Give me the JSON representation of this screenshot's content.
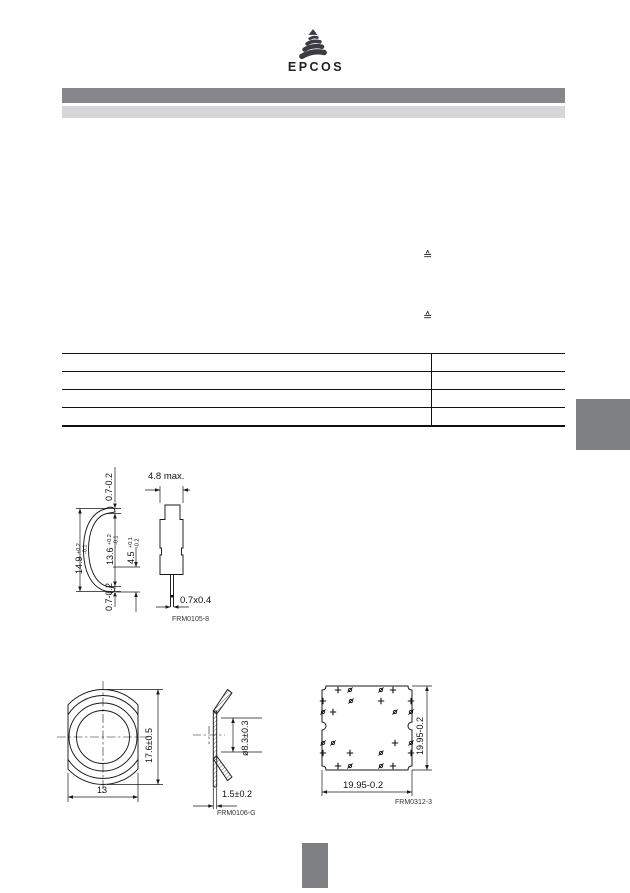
{
  "logo": {
    "text": "EPCOS",
    "icon_color": "#3a3b43",
    "text_color": "#1f2028"
  },
  "header": {
    "bar_primary_color": "#86878b",
    "bar_secondary_color": "#d6d6d8"
  },
  "content": {
    "corresponds_symbol_1": "≙",
    "corresponds_symbol_2": "≙"
  },
  "table": {
    "row_count": 4,
    "line_color": "#111111"
  },
  "page_markers": {
    "side_tab_color": "#7e8084",
    "footer_block_color": "#7e8084"
  },
  "drawings": {
    "component_side": {
      "label": "FRM0105-8",
      "dim_top_tab": "0.7-0.2",
      "dim_total_height": "14.9",
      "dim_total_height_tol_plus": "+0.2",
      "dim_total_height_tol_minus": "-0.1",
      "dim_body_height": "13.6",
      "dim_body_height_tol_plus": "+0.2",
      "dim_body_height_tol_minus": "-0.1",
      "dim_lead_length": "4.5",
      "dim_lead_length_tol_plus": "+0.1",
      "dim_lead_length_tol_minus": "-0.2",
      "dim_bottom_tab": "0.7-0.2",
      "dim_width": "4.8 max.",
      "dim_lead_cross_section": "0.7x0.4"
    },
    "component_top": {
      "dim_height": "17.6±0.5",
      "dim_width": "13"
    },
    "washer_section": {
      "label": "FRM0106-G",
      "dim_inner_diameter": "ø8.3±0.3",
      "dim_thickness": "1.5±0.2"
    },
    "pcb_layout": {
      "label": "FRM0312-3",
      "dim_height": "19.95-0.2",
      "dim_width": "19.95-0.2",
      "marks": [
        {
          "t": "plus",
          "x": 28,
          "y": 30
        },
        {
          "t": "oslash",
          "x": 40,
          "y": 30
        },
        {
          "t": "oslash",
          "x": 71,
          "y": 30
        },
        {
          "t": "plus",
          "x": 83,
          "y": 30
        },
        {
          "t": "plus",
          "x": 13,
          "y": 41
        },
        {
          "t": "oslash",
          "x": 41,
          "y": 41
        },
        {
          "t": "plus",
          "x": 71,
          "y": 41
        },
        {
          "t": "plus",
          "x": 101,
          "y": 41
        },
        {
          "t": "oslash",
          "x": 13,
          "y": 52
        },
        {
          "t": "plus",
          "x": 23,
          "y": 52
        },
        {
          "t": "oslash",
          "x": 85,
          "y": 52
        },
        {
          "t": "oslash",
          "x": 101,
          "y": 52
        },
        {
          "t": "oslash",
          "x": 13,
          "y": 83
        },
        {
          "t": "oslash",
          "x": 23,
          "y": 83
        },
        {
          "t": "plus",
          "x": 85,
          "y": 83
        },
        {
          "t": "oslash",
          "x": 101,
          "y": 83
        },
        {
          "t": "plus",
          "x": 13,
          "y": 93
        },
        {
          "t": "plus",
          "x": 40,
          "y": 93
        },
        {
          "t": "oslash",
          "x": 71,
          "y": 93
        },
        {
          "t": "plus",
          "x": 101,
          "y": 93
        },
        {
          "t": "plus",
          "x": 28,
          "y": 106
        },
        {
          "t": "oslash",
          "x": 40,
          "y": 106
        },
        {
          "t": "oslash",
          "x": 71,
          "y": 106
        },
        {
          "t": "plus",
          "x": 83,
          "y": 106
        }
      ]
    }
  }
}
